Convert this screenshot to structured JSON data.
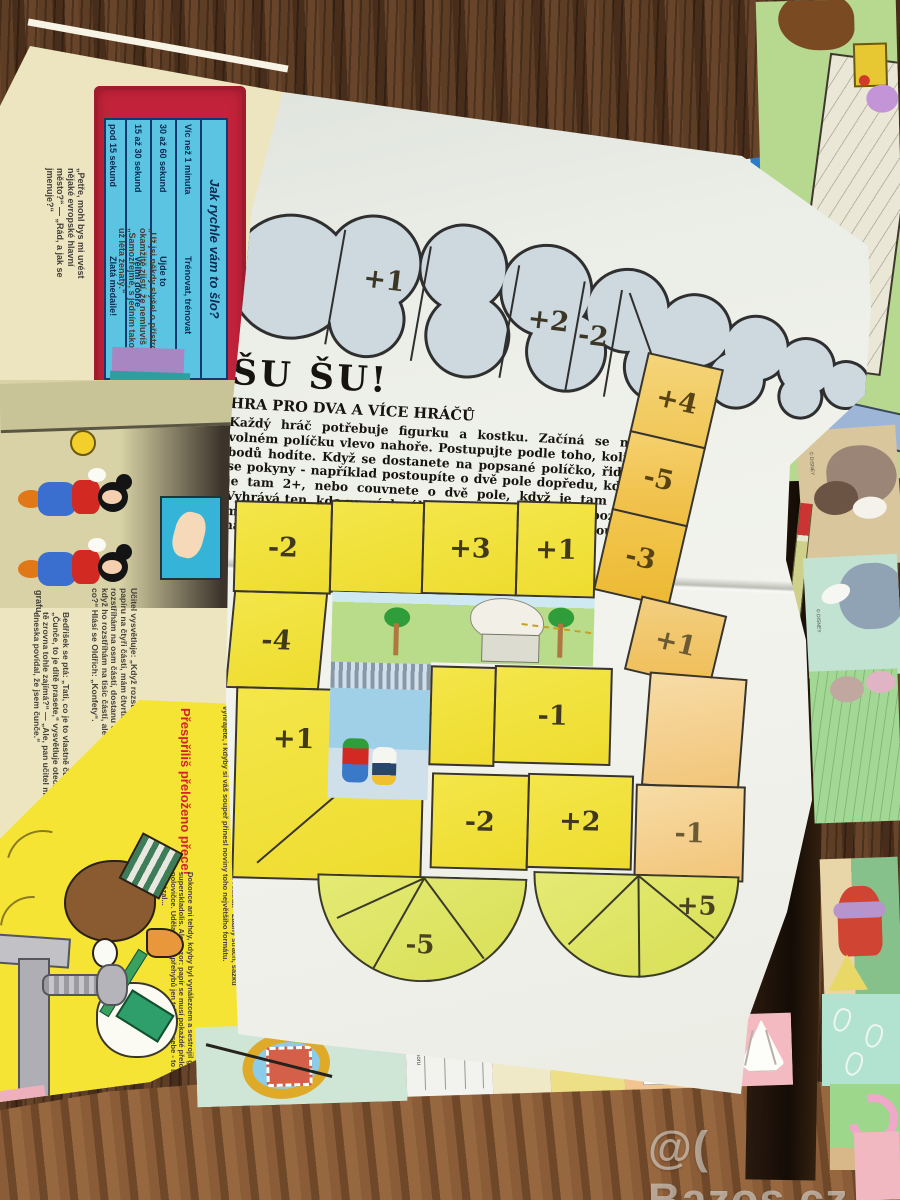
{
  "watermark": "@( Bazos.cz",
  "board": {
    "title": "ŠU ŠU!",
    "subtitle": "HRA PRO DVA A VÍCE HRÁČŮ",
    "rules": "Každý hráč potřebuje figurku a kostku. Začíná se na volném políčku vlevo nahoře. Postupujte podle toho, kolik bodů hodíte. Když se dostanete na popsané políčko, řiďte se pokyny - například postoupíte o dvě pole dopředu, když je tam 2+, nebo couvnete o dvě pole, když je tam 2-. Vyhrává ten, kdo první dosáhne posledního pole, ale pozor, musí se strefit. Pokud hodí příliš mnoho, musí couvnout a házet znova.",
    "cloud_cells": [
      "",
      "+1",
      "",
      "+2",
      "-2"
    ],
    "right_column_upper": [
      "+4",
      "-5",
      "-3"
    ],
    "row_top": [
      "-2",
      "",
      "+3",
      "+1"
    ],
    "left_column": [
      "-4",
      "+1"
    ],
    "row_mid": [
      "",
      "-1"
    ],
    "row_lower": [
      "-2",
      "+2"
    ],
    "right_column_lower": [
      "+1",
      "",
      "-1"
    ],
    "fans": [
      "-5",
      "+5"
    ]
  },
  "left_page": {
    "note_top": "nesmí minci dotknout.",
    "speed_table": {
      "title": "Jak rychle vám to šlo?",
      "rows": [
        {
          "time": "Víc než 1 minuta",
          "verdict": "Trénovat, trénovat"
        },
        {
          "time": "30 až 60 sekund",
          "verdict": "Ujde to"
        },
        {
          "time": "15 až 30 sekund",
          "verdict": "Velmi dobře"
        },
        {
          "time": "pod 15 sekund",
          "verdict": "Zlatá medaile!"
        }
      ]
    },
    "joke_city": "„Petře, mohl bys mi uvést nějaké evropské hlavní město?“ — „Rád, a jak se jmenuje?“",
    "joke_machine": "„Už jsi někdy slyšel o přístroji, který okamžitě zjistí, že nemluvíš pravdu?“ - „Samozřejmě, s jedním takovým jsem už léta ženatý.“",
    "word_grafu": "grafu.",
    "joke_confetti": "Učitel vysvětluje: „Když rozstříhám list papíru na čtyři části, mám čtvrtiny. Když ho rozstříhám na osm částí, dostanu osminy. A když ho rozstříhám na tisíc částí, ale mám co?“ Hlásí se Oldřich: „Konfety“.",
    "joke_pig": "Bedřišek se ptá: „Tati, co je to vlastně čunče?“ — „Čunče, to je dítě prasete,“ vysvětluje otec. „A proč tě zrovna tohle zajímá?“ — „Ale, pan učitel mi dneska povídal, že jsem čunče.“",
    "fold_article": {
      "title": "Přespříliš přeloženo přece!",
      "lead": "„Vsaďte se, že žádný papír nepřeložíte víc než devětkrát!“ Žádný strach, sázku vyhrajete, i kdyby si váš soupeř přinesl noviny toho největšího formátu.",
      "body": "Dokonce ani tehdy, kdyby byl vynálezcem a sestrojil geniální superskladolis. Ale pozor: papír se musí pokaždé přeložit v polovičce. Udělat devět přehybů jen tak vedle sebe - to by dokázal..."
    }
  },
  "bottom_strip": {
    "fragment_small": "couvnout nahoru",
    "fragment_fold": "Bod B a C přiložíme ke středové čáře a vzniklou špičku přehneme."
  },
  "right_pages": {
    "disney_mark": "© DISNEY"
  },
  "colors": {
    "board_yellow": "#f2e13a",
    "cloud_blue": "#cdd9de",
    "column_orange": "#f0c050",
    "fan_green": "#dfe468",
    "frame_red": "#c2233a",
    "table_blue": "#58c8e4"
  }
}
